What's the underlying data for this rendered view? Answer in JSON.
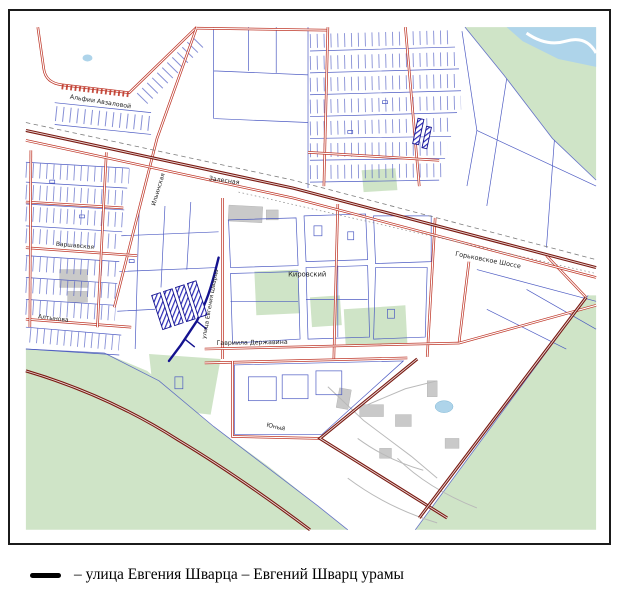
{
  "legend": {
    "symbol": "thick-black-line",
    "text": "– улица Евгения Шварца – Евгений Шварц урамы"
  },
  "map": {
    "colors": {
      "green": "#cfe4c7",
      "water": "#aed4ea",
      "parcel_blue": "#4553c0",
      "street_red": "#bf382a",
      "road_dark": "#7a1a12",
      "highlight_blue": "#14128f",
      "building_gray": "#c9c9c9",
      "rail_gray": "#7d7d7d",
      "label_color": "#1f1f1f"
    },
    "labels": [
      {
        "id": "alfii-avzalovoy",
        "text": "Альфии Авзаловой",
        "x": 60,
        "y": 88,
        "rot": 9,
        "size": 6.3
      },
      {
        "id": "zalesnaya",
        "text": "Залесная",
        "x": 200,
        "y": 170,
        "rot": 8,
        "size": 6.3
      },
      {
        "id": "gorkovskoe-shosse",
        "text": "Горьковское Шоссе",
        "x": 448,
        "y": 246,
        "rot": 11,
        "size": 6.5
      },
      {
        "id": "kirovskiy",
        "text": "Кировский",
        "x": 280,
        "y": 267,
        "rot": 0,
        "size": 6.8
      },
      {
        "id": "gavriila-derzhavina",
        "text": "Гавриила Державина",
        "x": 208,
        "y": 336,
        "rot": -1,
        "size": 6.3
      },
      {
        "id": "altynova",
        "text": "Алтынова",
        "x": 28,
        "y": 309,
        "rot": 7,
        "size": 6
      },
      {
        "id": "varshavskaya",
        "text": "Варшавская",
        "x": 46,
        "y": 236,
        "rot": 5,
        "size": 6
      },
      {
        "id": "ilinskaya",
        "text": "Ильинская",
        "x": 146,
        "y": 196,
        "rot": -73,
        "size": 6
      },
      {
        "id": "yuny",
        "text": "Юный",
        "x": 258,
        "y": 418,
        "rot": 13,
        "size": 6
      },
      {
        "id": "ulitsa-evgeniya-shvartsa",
        "text": "улица Евгения Шварца",
        "x": 197,
        "y": 330,
        "rot": -80,
        "size": 5.8
      }
    ]
  }
}
